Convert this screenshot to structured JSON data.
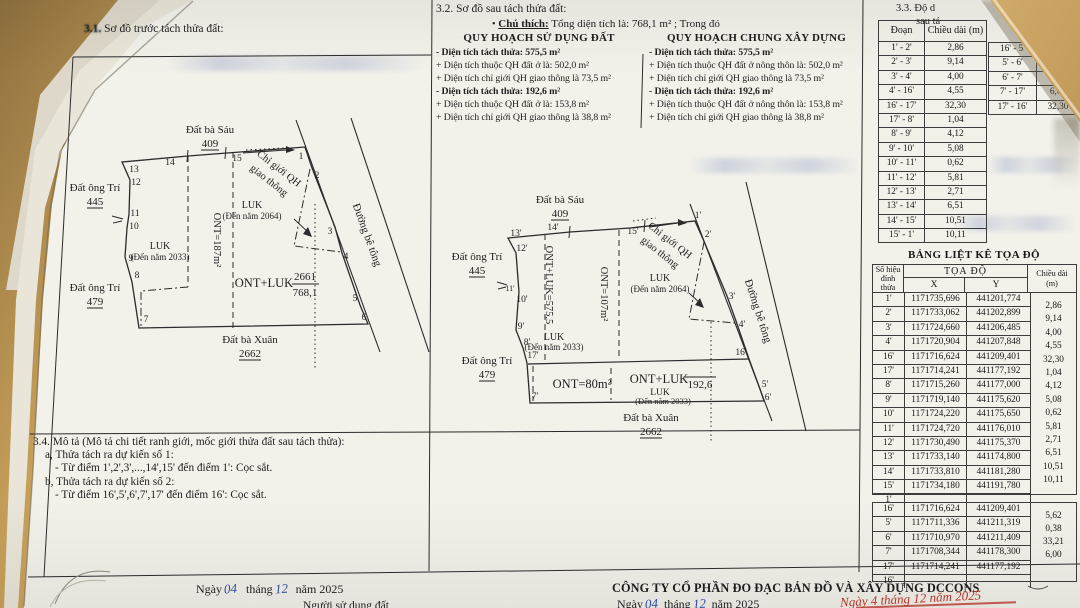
{
  "doc": {
    "s31": {
      "num": "3.1.",
      "title": " Sơ đồ trước tách thửa đất:"
    },
    "s32": {
      "title": "3.2. Sơ đồ sau tách thửa đất:"
    },
    "legend": {
      "bullet": "•",
      "chu_thich": "Chú thích:",
      "total": "Tổng diện tích là: 768,1 m²  ; Trong đó",
      "col1_title": "QUY HOẠCH SỬ DỤNG ĐẤT",
      "col1": [
        "- Diện tích tách thửa: 575,5 m²",
        "+ Diện tích thuộc QH đất ở là: 502,0 m²",
        "+ Diện tích chỉ giới QH giao thông là 73,5 m²",
        "- Diện tích tách thửa: 192,6 m²",
        "+ Diện tích thuộc QH đất ở là: 153,8 m²",
        "+ Diện tích chỉ giới QH giao thông là 38,8 m²"
      ],
      "col2_title": "QUY HOẠCH CHUNG XÂY DỰNG",
      "col2": [
        "- Diện tích tách thửa: 575,5 m²",
        "+ Diện tích thuộc QH đất ở nông thôn là: 502,0 m²",
        "+ Diện tích chỉ giới QH giao thông là 73,5 m²",
        "- Diện tích tách thửa: 192,6 m²",
        "+ Diện tích thuộc QH đất ở nông thôn là: 153,8 m²",
        "+ Diện tích chỉ giới QH giao thông là 38,8 m²"
      ]
    },
    "s33": {
      "l1": "3.3. Độ d",
      "l2": "sau tá"
    },
    "seg1": {
      "h1": "Đoạn",
      "h2": "Chiều dài (m)",
      "rows": [
        [
          "1' - 2'",
          "2,86"
        ],
        [
          "2' - 3'",
          "9,14"
        ],
        [
          "3' - 4'",
          "4,00"
        ],
        [
          "4' - 16'",
          "4,55"
        ],
        [
          "16' - 17'",
          "32,30"
        ],
        [
          "17' - 8'",
          "1,04"
        ],
        [
          "8' - 9'",
          "4,12"
        ],
        [
          "9' - 10'",
          "5,08"
        ],
        [
          "10' - 11'",
          "0,62"
        ],
        [
          "11' - 12'",
          "5,81"
        ],
        [
          "12' - 13'",
          "2,71"
        ],
        [
          "13' - 14'",
          "6,51"
        ],
        [
          "14' - 15'",
          "10,51"
        ],
        [
          "15' - 1'",
          "10,11"
        ]
      ]
    },
    "seg2": {
      "rows": [
        [
          "16' - 5'",
          ""
        ],
        [
          "5' - 6'",
          ""
        ],
        [
          "6' - 7'",
          "33,2"
        ],
        [
          "7' - 17'",
          "6,00"
        ],
        [
          "17' - 16'",
          "32,30"
        ]
      ]
    },
    "coord": {
      "title": "BẢNG LIỆT KÊ TỌA ĐỘ",
      "h_id1": "Số hiệu",
      "h_id2": "đỉnh thửa",
      "h_xy": "TỌA ĐỘ",
      "h_x": "X",
      "h_y": "Y",
      "h_cd1": "Chiều dài",
      "h_cd2": "(m)",
      "rows1": [
        [
          "1'",
          "1171735,696",
          "441201,774"
        ],
        [
          "2'",
          "1171733,062",
          "441202,899"
        ],
        [
          "3'",
          "1171724,660",
          "441206,485"
        ],
        [
          "4'",
          "1171720,904",
          "441207,848"
        ],
        [
          "16'",
          "1171716,624",
          "441209,401"
        ],
        [
          "17'",
          "1171714,241",
          "441177,192"
        ],
        [
          "8'",
          "1171715,260",
          "441177,000"
        ],
        [
          "9'",
          "1171719,140",
          "441175,620"
        ],
        [
          "10'",
          "1171724,220",
          "441175,650"
        ],
        [
          "11'",
          "1171724,720",
          "441176,010"
        ],
        [
          "12'",
          "1171730,490",
          "441175,370"
        ],
        [
          "13'",
          "1171733,140",
          "441174,800"
        ],
        [
          "14'",
          "1171733,810",
          "441181,280"
        ],
        [
          "15'",
          "1171734,180",
          "441191,780"
        ],
        [
          "1'",
          "",
          ""
        ]
      ],
      "cd1": [
        "2,86",
        "9,14",
        "4,00",
        "4,55",
        "32,30",
        "1,04",
        "4,12",
        "5,08",
        "0,62",
        "5,81",
        "2,71",
        "6,51",
        "10,51",
        "10,11"
      ],
      "rows2": [
        [
          "16'",
          "1171716,624",
          "441209,401"
        ],
        [
          "5'",
          "1171711,336",
          "441211,319"
        ],
        [
          "6'",
          "1171710,970",
          "441211,409"
        ],
        [
          "7'",
          "1171708,344",
          "441178,300"
        ],
        [
          "17'",
          "1171714,241",
          "441177,192"
        ],
        [
          "16'",
          "",
          ""
        ]
      ],
      "cd2": [
        "5,62",
        "0,38",
        "33,21",
        "6,00"
      ]
    },
    "s34": {
      "title": "3.4. Mô tả (Mô tả chi tiết ranh giới, mốc giới thửa đất sau tách thửa):",
      "a": "a, Thửa tách ra dự kiến số 1:",
      "a1": "- Từ điểm 1',2',3',...,14',15' đến điểm 1': Cọc sắt.",
      "b": "b, Thửa tách ra dự kiến số 2:",
      "b1": "- Từ điểm 16',5',6',7',17' đến điểm 16': Cọc sắt."
    },
    "footer": {
      "ngay": "Ngày",
      "d": "04",
      "thang": "tháng",
      "m": "12",
      "nam": "năm 2025",
      "nguoi": "Người sử dụng đất",
      "company": "CÔNG TY CỔ PHẦN ĐO ĐẠC BẢN ĐỒ VÀ XÂY DỰNG DCCONS",
      "red_note": "Ngày 4 tháng 12 năm 2025"
    },
    "map1": {
      "top1": "Đất bà Sáu",
      "top2": "409",
      "left1a": "Đất ông Trí",
      "left1b": "445",
      "left2a": "Đất ông Trí",
      "left2b": "479",
      "bot1": "Đất bà Xuân",
      "bot2": "2662",
      "road": "Đường bê tông",
      "cg1": "Chỉ giới QH",
      "cg2": "giao thông",
      "luk64a": "LUK",
      "luk64b": "(Đến năm 2064)",
      "luk33a": "LUK",
      "luk33b": "(Đến năm 2033)",
      "ont187": "ONT=187m²",
      "ontluk": "ONT+LUK",
      "fr_top": "2661",
      "fr_bot": "768,1",
      "v": [
        "13",
        "14",
        "15",
        "1",
        "2",
        "3",
        "4",
        "5",
        "6",
        "7",
        "8",
        "9",
        "10",
        "11",
        "12"
      ]
    },
    "map2": {
      "top1": "Đất bà Sáu",
      "top2": "409",
      "left1a": "Đất ông Trí",
      "left1b": "445",
      "left2a": "Đất ông Trí",
      "left2b": "479",
      "bot1": "Đất bà Xuân",
      "bot2": "2662",
      "road": "Đường bê tông",
      "cg1": "Chỉ giới QH",
      "cg2": "giao thông",
      "luk64a": "LUK",
      "luk64b": "(Đến năm 2064)",
      "luk33a": "LUK",
      "luk33b": "(Đến năm 2033)",
      "ont575": "ONT+LUK=575,5",
      "ont107": "ONT=107m²",
      "ont80": "ONT=80m²",
      "ontluk192": "ONT+LUK",
      "v192": "192,6",
      "luk33c": "LUK",
      "luk33d": "(Đến năm 2033)",
      "v": [
        "13'",
        "14'",
        "15'",
        "1'",
        "2'",
        "3'",
        "4'",
        "16'",
        "5'",
        "6'",
        "7'",
        "17'",
        "8'",
        "9'",
        "10'",
        "11'",
        "12'"
      ]
    },
    "colors": {
      "paper": "#f2f1ea",
      "desk": "#c59e58",
      "ink": "#1e1e1e",
      "hand_blue": "#2d4a9e",
      "stamp_red": "#b5342a"
    }
  }
}
